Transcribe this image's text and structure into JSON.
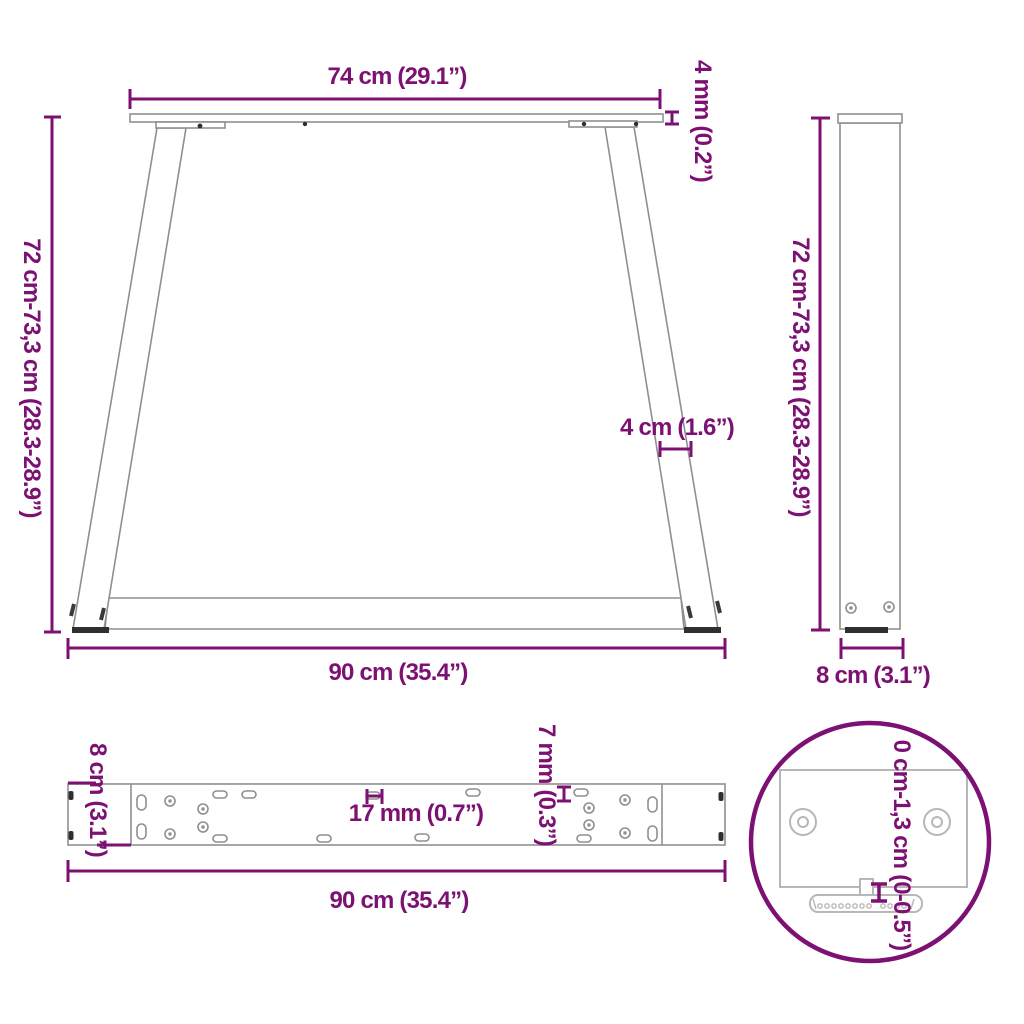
{
  "diagram": {
    "type": "furniture-dimension-drawing",
    "subject": "V-shape table legs with crossbar, dimension views",
    "colors": {
      "dimension_accent": "#7d1173",
      "drawing_line": "#8f8f8f",
      "detail_line": "#b7b7b7",
      "dark_fitting": "#2f2f2f",
      "background": "#ffffff"
    },
    "views": {
      "front": {
        "top_width": "74 cm (29.1”)",
        "plate_thickness": "4 mm (0.2”)",
        "height_range": "72 cm-73,3 cm (28.3-28.9”)",
        "leg_profile_width": "4 cm (1.6”)",
        "bottom_width": "90 cm (35.4”)"
      },
      "side": {
        "height_range": "72 cm-73,3 cm (28.3-28.9”)",
        "depth": "8 cm (3.1”)"
      },
      "top_bar": {
        "depth": "8 cm (3.1”)",
        "slot_length": "17 mm (0.7”)",
        "hole_width": "7 mm (0.3”)",
        "length": "90 cm (35.4”)"
      },
      "foot_detail": {
        "adjustable_height_range": "0 cm-1,3 cm (0-0.5”)"
      }
    }
  }
}
